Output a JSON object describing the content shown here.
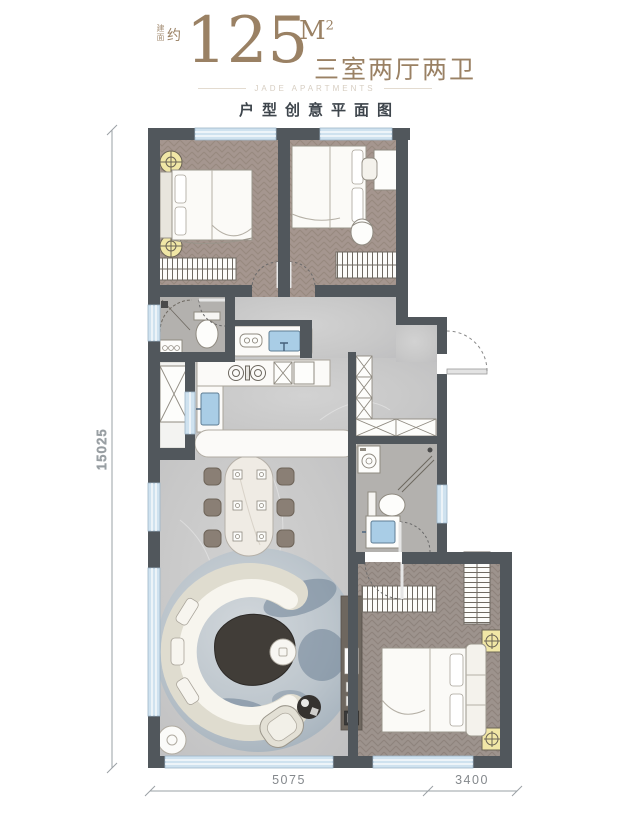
{
  "header": {
    "area_label_small": "建面",
    "area_label_approx": "约",
    "area_value": "125",
    "area_unit": "M",
    "area_unit_exp": "2",
    "layout_text": "三室两厅两卫",
    "watermark": "JADE APARTMENTS",
    "subtitle": "户型创意平面图"
  },
  "dimensions": {
    "left_total": "15025",
    "bottom_left": "5075",
    "bottom_right": "3400"
  },
  "colors": {
    "accent_gold": "#9a8164",
    "text_dark": "#3e454c",
    "wall": "#51575c",
    "window_blue": "#cfe2ef",
    "floor_wood": "#a5968f",
    "floor_wood_dark": "#9d938d",
    "floor_marble": "#c9c9c9",
    "floor_tile": "#b3b1ae",
    "lamp_yellow": "#f1e7a6",
    "sink_blue": "#a9cde6",
    "dim_text": "#84888c"
  }
}
